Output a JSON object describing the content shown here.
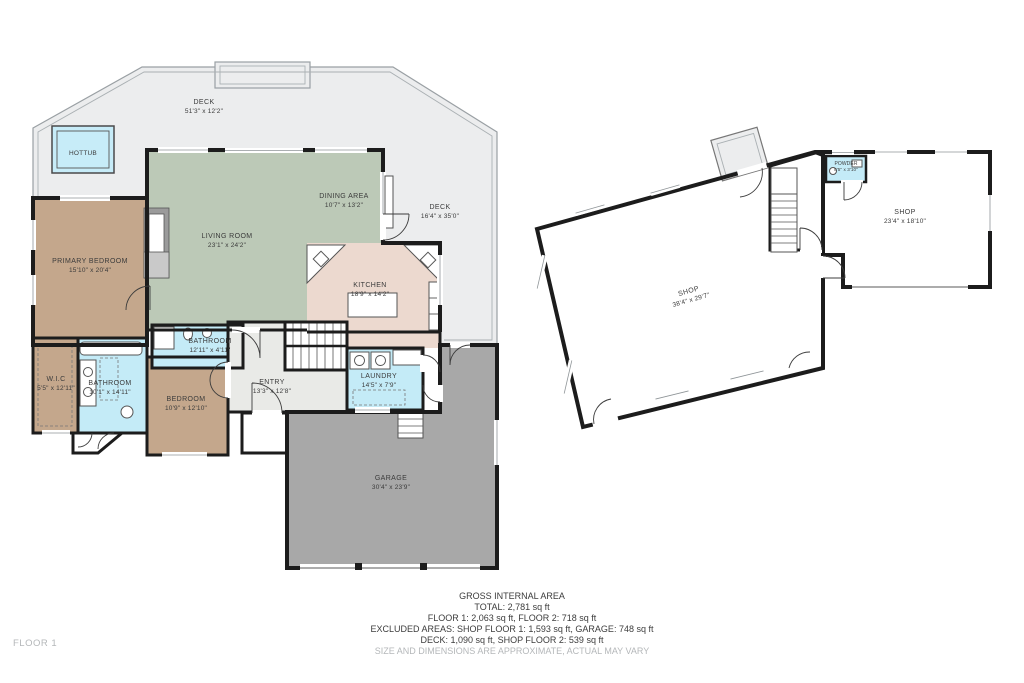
{
  "palette": {
    "deck": "#ecedee",
    "hall": "#e9eae7",
    "room_green": "#bcc9b7",
    "room_brown": "#c4a78c",
    "room_blue": "#c4ebf7",
    "room_pink": "#ecd9cf",
    "garage_gray": "#a8a8a8",
    "hottub_blue": "#c7ecf8",
    "wall": "#1c1c1c",
    "label": "#3b3b3b",
    "muted": "#b4b7b9",
    "white": "#ffffff",
    "fireplace_gray": "#9b9b9b"
  },
  "rooms": {
    "deck_top": {
      "name": "DECK",
      "dims": "51'3\" x 12'2\""
    },
    "hottub": {
      "name": "HOTTUB"
    },
    "deck_right": {
      "name": "DECK",
      "dims": "16'4\" x 35'0\""
    },
    "living_room": {
      "name": "LIVING ROOM",
      "dims": "23'1\" x 24'2\""
    },
    "dining_area": {
      "name": "DINING AREA",
      "dims": "10'7\" x 13'2\""
    },
    "kitchen": {
      "name": "KITCHEN",
      "dims": "18'9\" x 14'2\""
    },
    "primary_bedroom": {
      "name": "PRIMARY BEDROOM",
      "dims": "15'10\" x 20'4\""
    },
    "primary_bathroom": {
      "name": "BATHROOM",
      "dims": "10'1\" x 14'11\""
    },
    "wic": {
      "name": "W.I.C",
      "dims": "5'5\" x 12'11\""
    },
    "bathroom2": {
      "name": "BATHROOM",
      "dims": "12'11\" x 4'11\""
    },
    "bedroom": {
      "name": "BEDROOM",
      "dims": "10'9\" x 12'10\""
    },
    "entry": {
      "name": "ENTRY",
      "dims": "13'3\" x 12'8\""
    },
    "laundry": {
      "name": "LAUNDRY",
      "dims": "14'5\" x 7'9\""
    },
    "garage": {
      "name": "GARAGE",
      "dims": "30'4\" x 23'9\""
    },
    "shop_main": {
      "name": "SHOP",
      "dims": "38'4\" x 29'7\""
    },
    "shop_second": {
      "name": "SHOP",
      "dims": "23'4\" x 18'10\""
    },
    "powder": {
      "name": "POWDER",
      "dims": "8'5\" x 3'10\""
    }
  },
  "footer": {
    "title": "GROSS INTERNAL AREA",
    "total": "TOTAL: 2,781 sq ft",
    "floors": "FLOOR 1: 2,063 sq ft, FLOOR 2: 718 sq ft",
    "excluded1": "EXCLUDED AREAS: SHOP FLOOR 1: 1,593 sq ft, GARAGE: 748 sq ft",
    "excluded2": "DECK: 1,090 sq ft, SHOP FLOOR 2: 539 sq ft",
    "disclaimer": "SIZE AND DIMENSIONS ARE APPROXIMATE, ACTUAL MAY VARY"
  },
  "floor_label": "FLOOR 1"
}
